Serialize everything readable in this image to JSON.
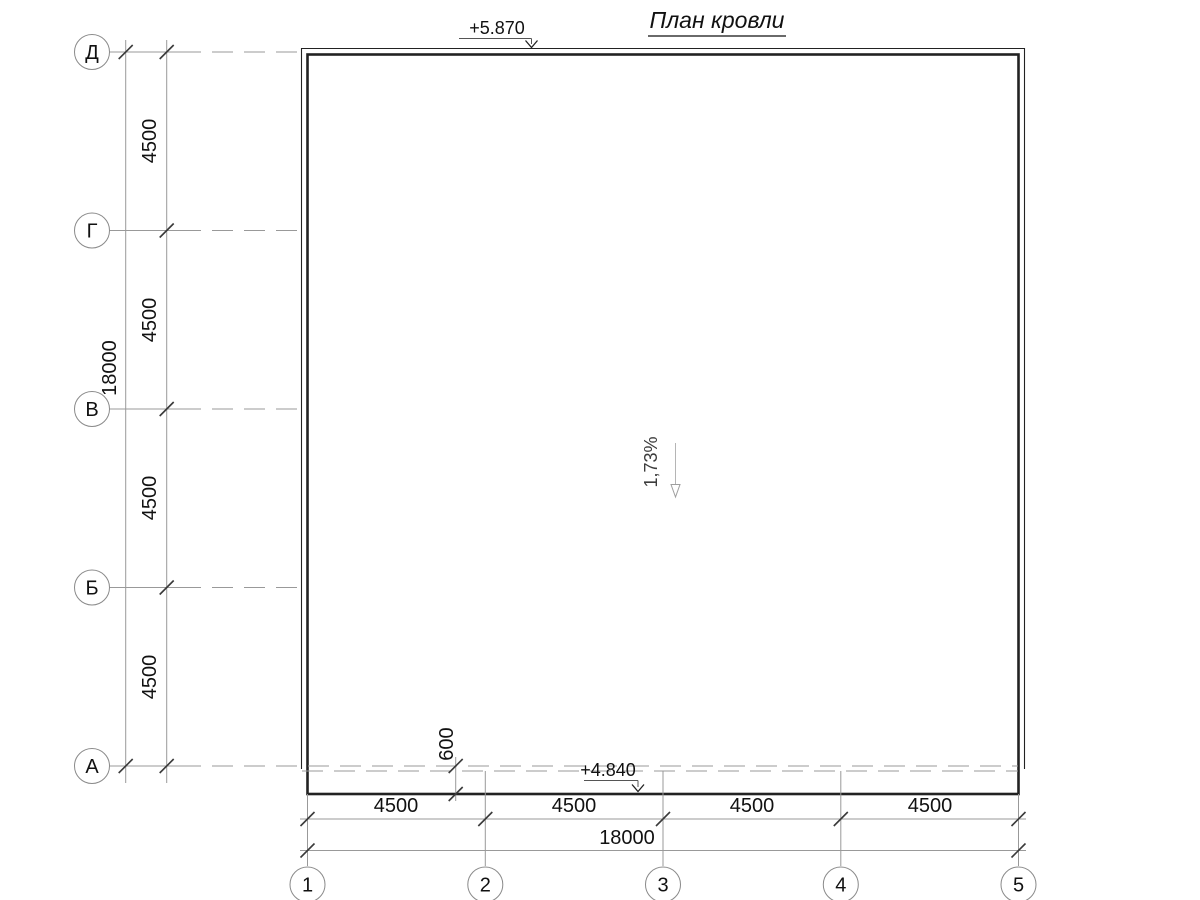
{
  "title": "План кровли",
  "row_axes": {
    "labels": [
      "Д",
      "Г",
      "В",
      "Б",
      "А"
    ]
  },
  "col_axes": {
    "labels": [
      "1",
      "2",
      "3",
      "4",
      "5"
    ]
  },
  "left_dims": {
    "segments": [
      "4500",
      "4500",
      "4500",
      "4500"
    ],
    "total": "18000"
  },
  "bottom_dims": {
    "segments": [
      "4500",
      "4500",
      "4500",
      "4500"
    ],
    "total": "18000"
  },
  "eave_dim": "600",
  "elevations": {
    "ridge": "+5.870",
    "eave": "+4.840"
  },
  "slope": "1,73%",
  "colors": {
    "outline": "#222222",
    "auxiliary": "#999999",
    "text": "#111111",
    "slope_arrow": "#b5b5b5"
  }
}
